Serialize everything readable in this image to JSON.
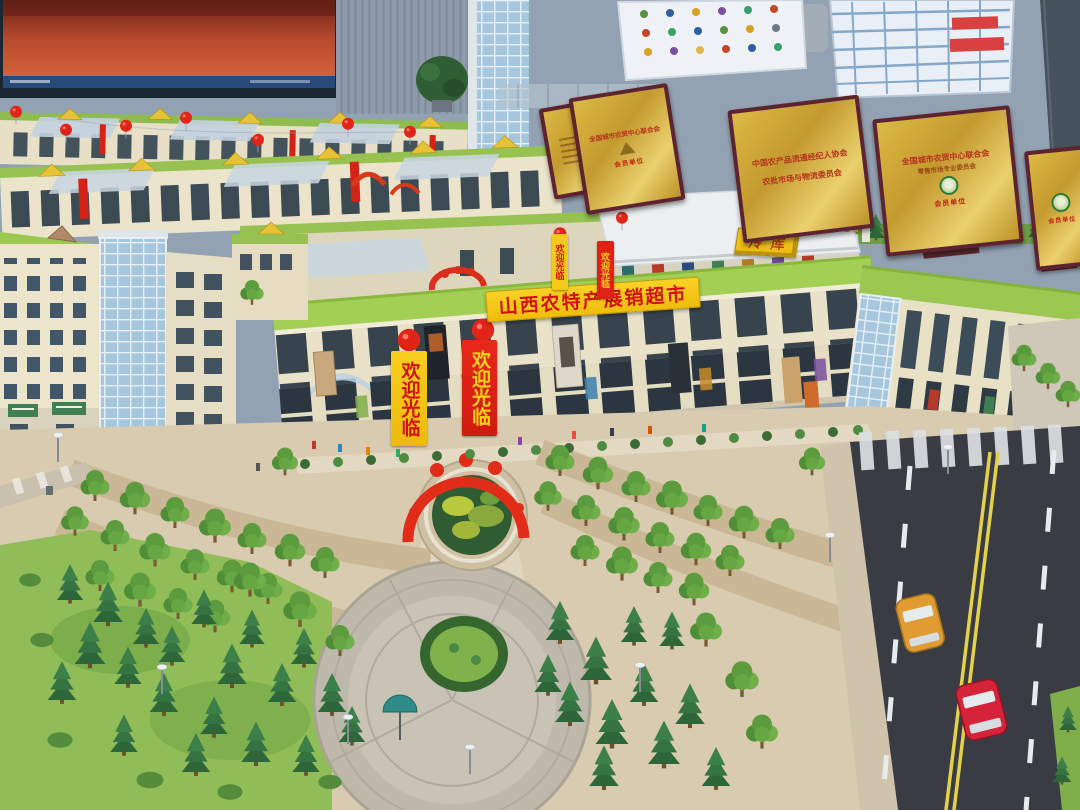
{
  "signs": {
    "main_roof_sign": "山西农特产展销超市",
    "welcome_banner": "欢迎光临",
    "cold_storage": "冷库"
  },
  "plaques": {
    "national_federation": "全国城市农贸中心联合会",
    "brokers_association": "中国农产品流通经纪人协会",
    "logistics_committee": "农批市场与物流委员会",
    "retail_committee": "零售市场专业委员会",
    "member_seal": "会员单位"
  },
  "colors": {
    "sign_yellow": "#f6c514",
    "sign_red_text": "#d11a12",
    "banner_red": "#e02114",
    "plaque_gold": "#c9a43a",
    "roof_green": "#a3cf55",
    "building_cream": "#e9e2c8",
    "road_asphalt": "#393d43",
    "lane_yellow": "#e5d04a"
  }
}
